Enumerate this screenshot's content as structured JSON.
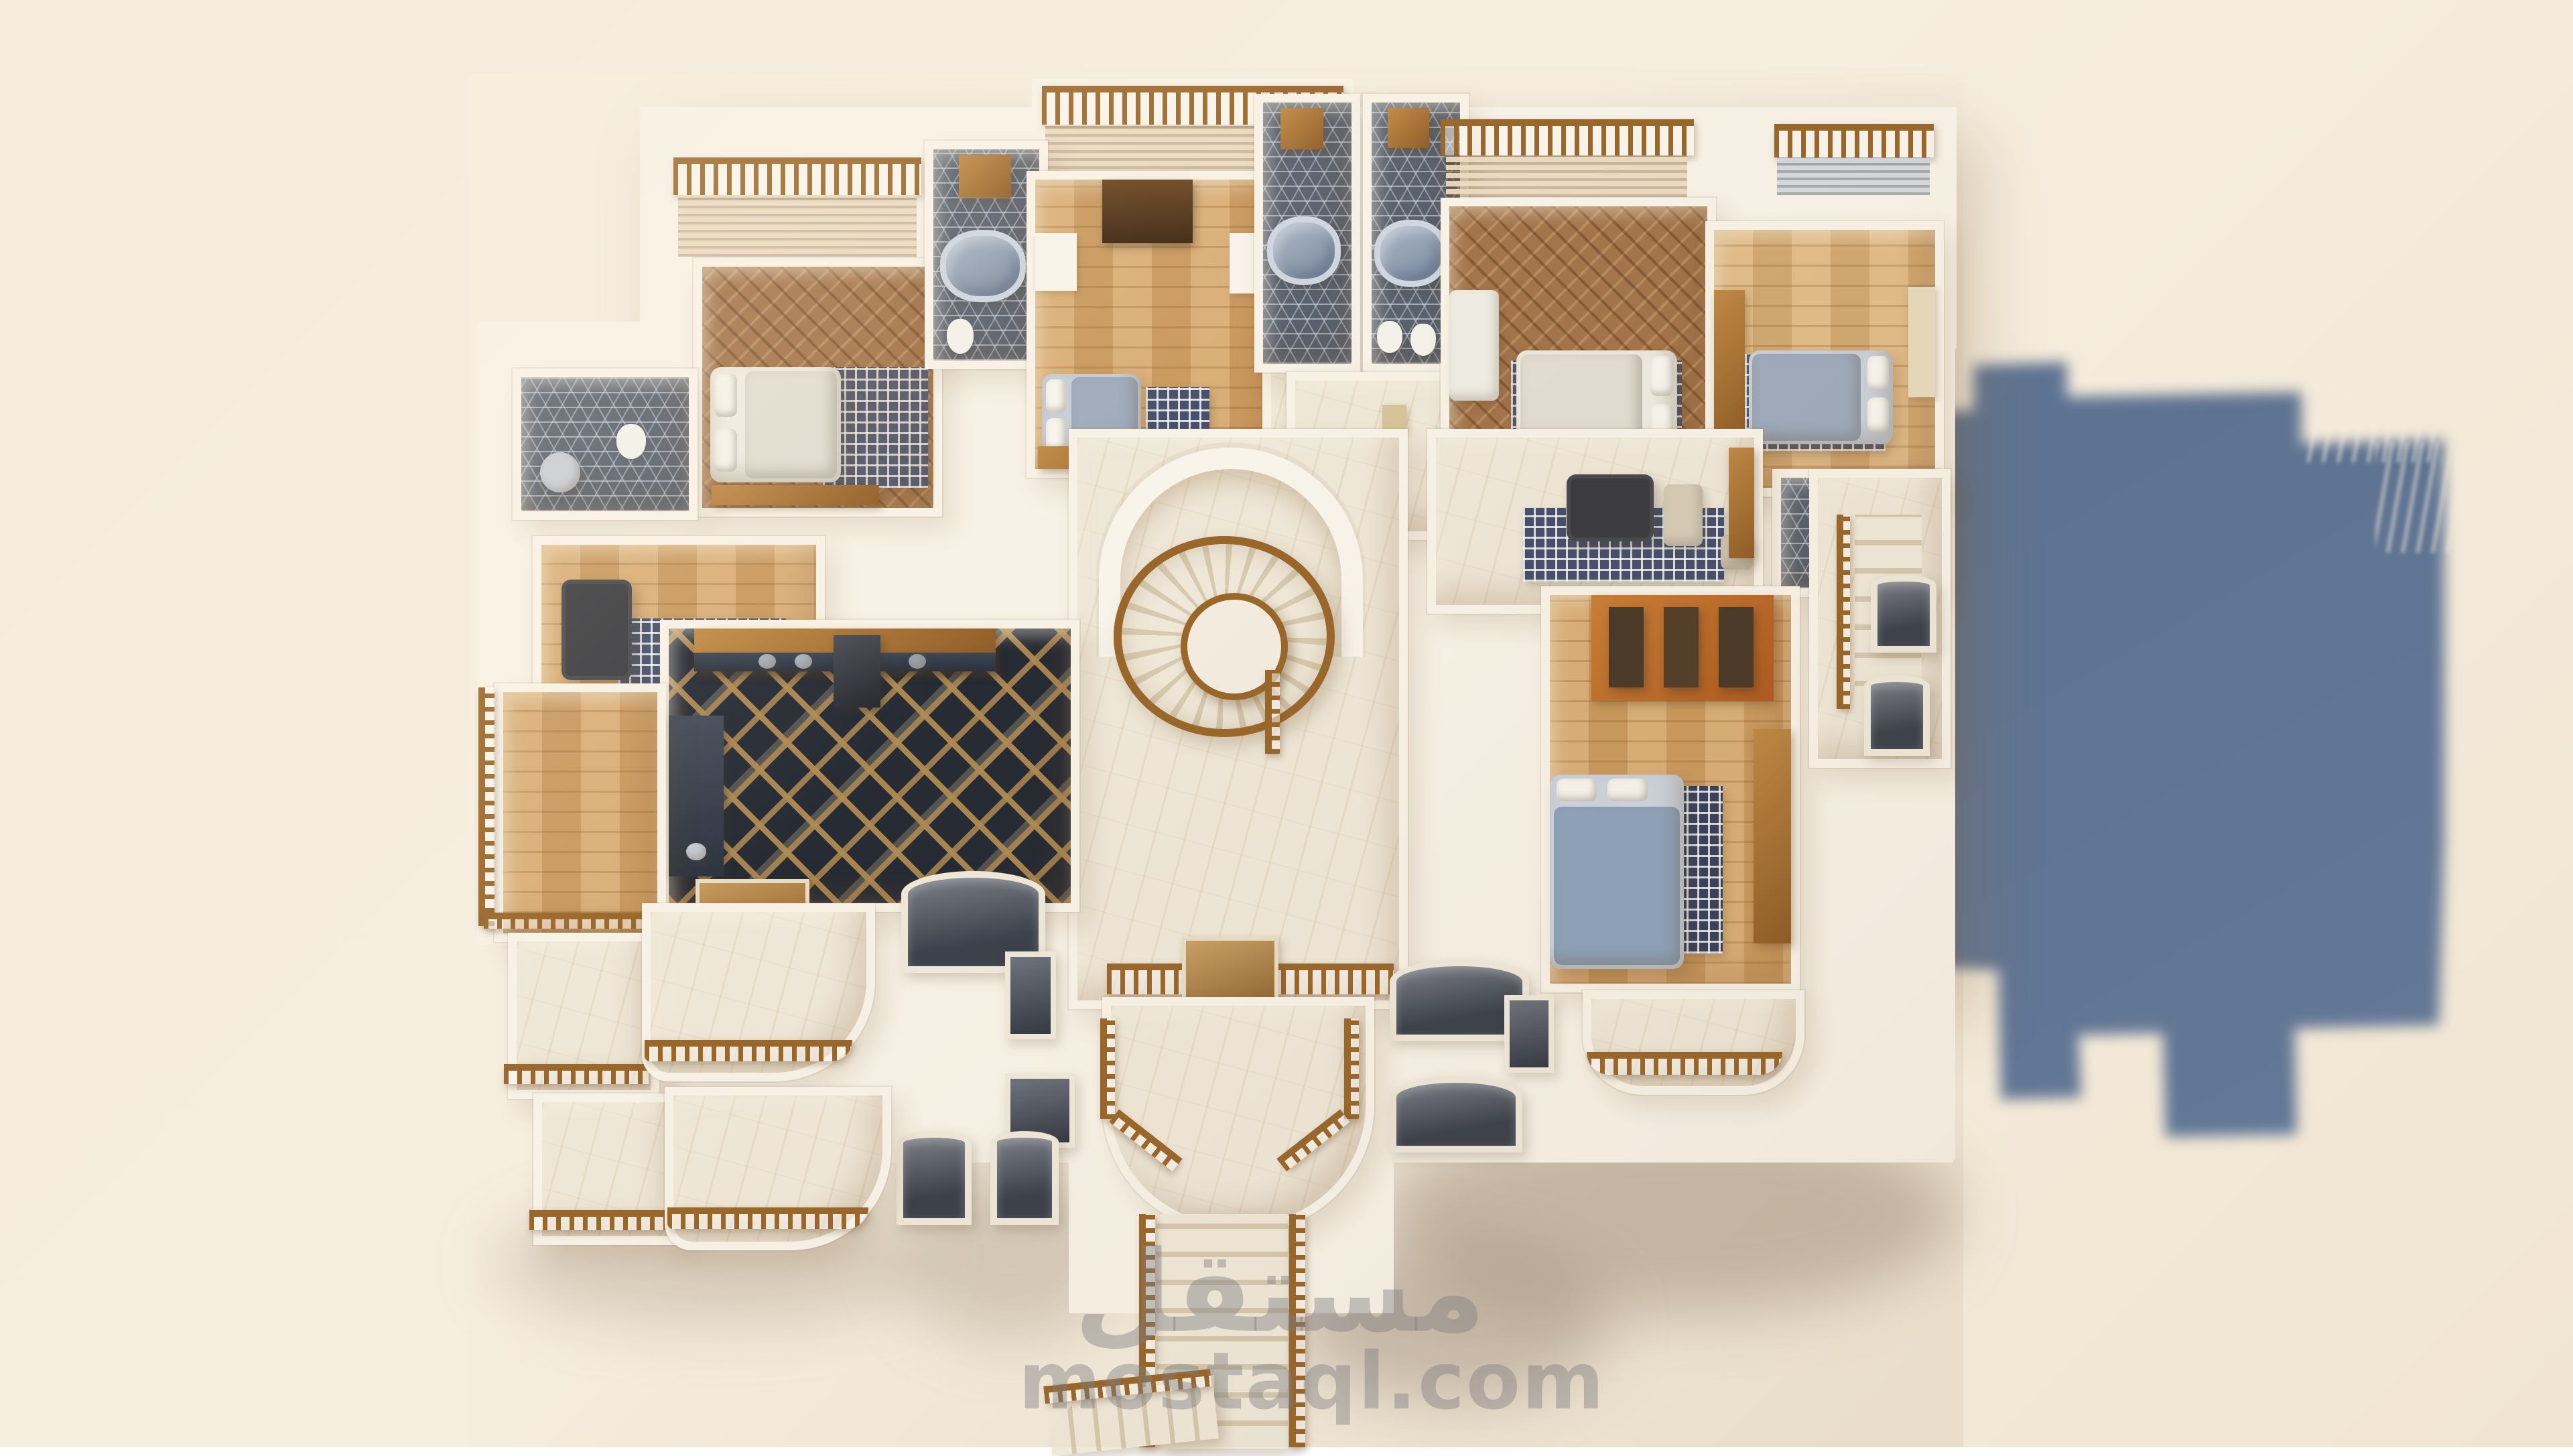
{
  "watermark": {
    "logo_text": "مستقل",
    "site_text": "mostaql.com"
  },
  "palette": {
    "bg": "#f5ecdd",
    "bgShade": "#f1e5d2",
    "shadowBlue": "#5e7391",
    "wall": "#f8f2e6",
    "marble": "#efe7d7",
    "mosaic": "#59616d",
    "kitchenDark": "#262b34",
    "railWood": "#9a672b",
    "bedWhite": "#efeae0",
    "bedGray": "#9fabbc",
    "tubGray": "#7c8a9e",
    "wardrobeOrange": "#b05a20"
  }
}
